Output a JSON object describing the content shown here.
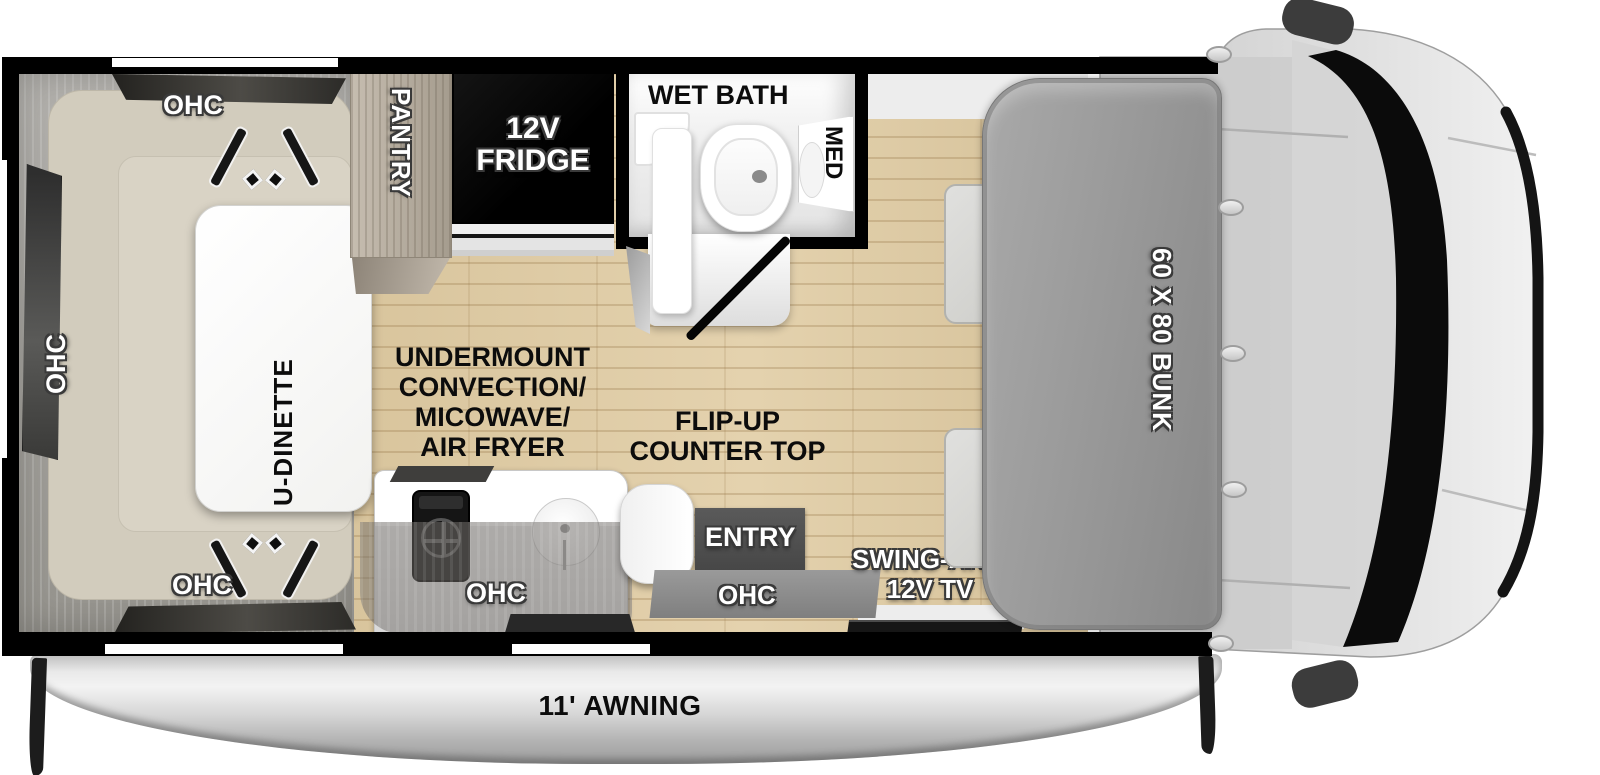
{
  "plan": {
    "dinette": {
      "table": "U-DINETTE",
      "ohc_top": "OHC",
      "ohc_left": "OHC",
      "ohc_bottom": "OHC"
    },
    "kitchen": {
      "pantry": "PANTRY",
      "fridge": [
        "12V",
        "FRIDGE"
      ],
      "appliance": [
        "UNDERMOUNT",
        "CONVECTION/",
        "MICOWAVE/",
        "AIR FRYER"
      ],
      "counter": [
        "FLIP-UP",
        "COUNTER TOP"
      ],
      "ohc": "OHC"
    },
    "bath": {
      "title": "WET BATH",
      "med": "MED"
    },
    "entry": {
      "label": "ENTRY",
      "ohc": "OHC"
    },
    "tv": [
      "SWING-ARM",
      "12V TV"
    ],
    "bunk": "60 X 80 BUNK",
    "awning": "11' AWNING"
  },
  "colors": {
    "wall": "#000000",
    "floor": "#dcc9a3",
    "floor_stripe": "#9a7842",
    "bunk": "#9b9b9b",
    "cushion": "#d2ccbd",
    "cab_body": "#d9d9d9",
    "windshield": "#0b0b0b",
    "fridge_bg": "#0a0a0a",
    "awning": "#c9c9c9",
    "entry_step": "#4e4e4e",
    "label_white": "#ffffff",
    "label_black": "#0c0c0c"
  }
}
